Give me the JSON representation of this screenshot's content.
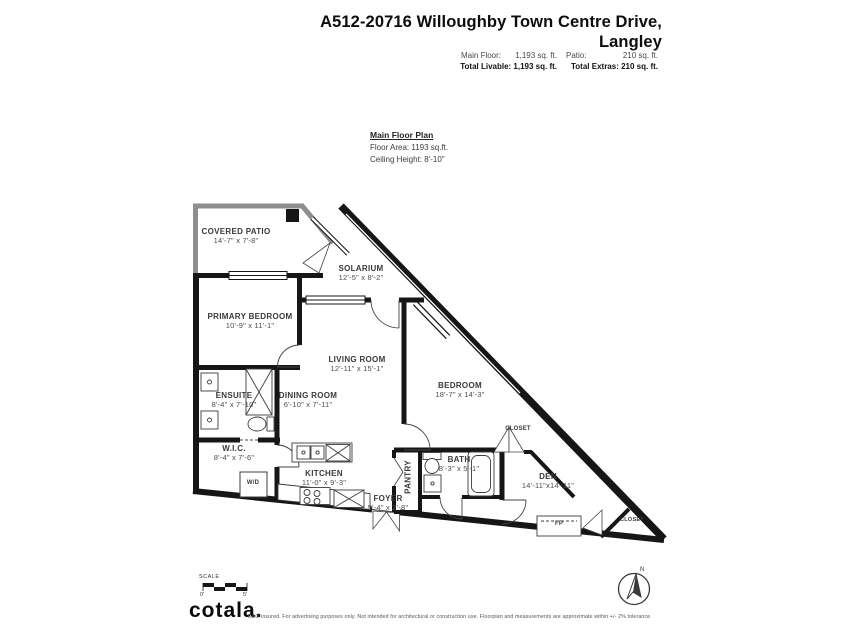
{
  "header": {
    "title_line1": "A512-20716 Willoughby Town Centre Drive,",
    "title_line2": "Langley",
    "stats": {
      "main_floor_label": "Main Floor:",
      "main_floor_value": "1,193 sq. ft.",
      "patio_label": "Patio:",
      "patio_value": "210 sq. ft.",
      "total_livable": "Total Livable: 1,193 sq. ft.",
      "total_extras": "Total Extras: 210 sq. ft."
    }
  },
  "plan_info": {
    "title": "Main Floor Plan",
    "floor_area": "Floor Area: 1193 sq.ft.",
    "ceiling_height": "Ceiling Height: 8'-10\""
  },
  "rooms": {
    "covered_patio": {
      "name": "COVERED PATIO",
      "dims": "14'-7\" x 7'-8\""
    },
    "solarium": {
      "name": "SOLARIUM",
      "dims": "12'-5\" x 8'-2\""
    },
    "primary_bedroom": {
      "name": "PRIMARY BEDROOM",
      "dims": "10'-9\" x 11'-1\""
    },
    "living_room": {
      "name": "LIVING ROOM",
      "dims": "12'-11\" x 15'-1\""
    },
    "dining_room": {
      "name": "DINING ROOM",
      "dims": "6'-10\" x 7'-11\""
    },
    "ensuite": {
      "name": "ENSUITE",
      "dims": "8'-4\" x 7'-10\""
    },
    "wic": {
      "name": "W.I.C.",
      "dims": "8'-4\" x 7'-6\""
    },
    "kitchen": {
      "name": "KITCHEN",
      "dims": "11'-0\" x 9'-3\""
    },
    "foyer": {
      "name": "FOYER",
      "dims": "5'-4\" x 2'-8\""
    },
    "pantry": {
      "name": "PANTRY"
    },
    "bath": {
      "name": "BATH",
      "dims": "8'-3\" x 5'-1\""
    },
    "bedroom": {
      "name": "BEDROOM",
      "dims": "18'-7\" x 14'-3\""
    },
    "den": {
      "name": "DEN",
      "dims": "14'-11\"x14'-11\""
    },
    "closet_1": {
      "name": "CLOSET"
    },
    "closet_2": {
      "name": "CLOSET"
    },
    "wd": {
      "name": "W/D"
    },
    "fp": {
      "name": "FP"
    }
  },
  "footer": {
    "scale_label": "SCALE",
    "scale_start": "0'",
    "scale_end": "5'",
    "logo": "cotala",
    "logo_period": ".",
    "disclaimer": "E&O insured. For advertising purposes only. Not intended for architectural or construction use. Floorplan and measurements are approximate within +/- 2% tolerance.",
    "compass_north": "N"
  },
  "colors": {
    "wall": "#161616",
    "patio_wall": "#8e8e8e",
    "text": "#3a3a3a",
    "background": "#ffffff"
  }
}
